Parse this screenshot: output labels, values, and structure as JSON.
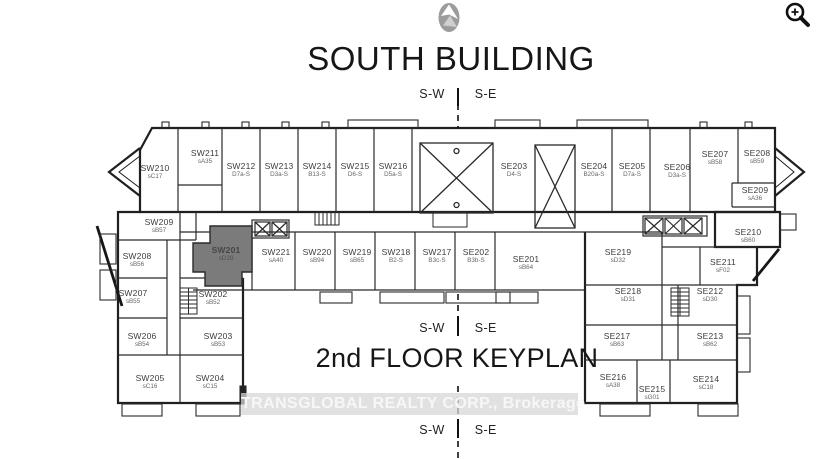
{
  "page": {
    "title": "SOUTH BUILDING",
    "keyplan_caption": "2nd FLOOR KEYPLAN",
    "direction_left": "S-W",
    "direction_right": "S-E",
    "watermark": "TRANSGLOBAL REALTY CORP., Brokerage",
    "highlight_color": "#7b7b7b",
    "wall_color": "#1f1f1f"
  },
  "icons": {
    "logo": "brand-logo",
    "zoom": "zoom-in-icon"
  },
  "units": [
    {
      "id": "SW210",
      "code": "sC17",
      "x": 155,
      "y": 172
    },
    {
      "id": "SW211",
      "code": "sA35",
      "x": 205,
      "y": 157
    },
    {
      "id": "SW212",
      "code": "D7a-S",
      "x": 241,
      "y": 170
    },
    {
      "id": "SW213",
      "code": "D3a-S",
      "x": 279,
      "y": 170
    },
    {
      "id": "SW214",
      "code": "B13-S",
      "x": 317,
      "y": 170
    },
    {
      "id": "SW215",
      "code": "D6-S",
      "x": 355,
      "y": 170
    },
    {
      "id": "SW216",
      "code": "D5a-S",
      "x": 393,
      "y": 170
    },
    {
      "id": "SE203",
      "code": "D4-S",
      "x": 514,
      "y": 170
    },
    {
      "id": "SE204",
      "code": "B20a-S",
      "x": 594,
      "y": 170
    },
    {
      "id": "SE205",
      "code": "D7a-S",
      "x": 632,
      "y": 170
    },
    {
      "id": "SE206",
      "code": "D3a-S",
      "x": 677,
      "y": 171
    },
    {
      "id": "SE207",
      "code": "sB58",
      "x": 715,
      "y": 158
    },
    {
      "id": "SE208",
      "code": "sB59",
      "x": 757,
      "y": 157
    },
    {
      "id": "SE209",
      "code": "sA36",
      "x": 755,
      "y": 194
    },
    {
      "id": "SW209",
      "code": "sB57",
      "x": 159,
      "y": 226
    },
    {
      "id": "SW208",
      "code": "sB56",
      "x": 137,
      "y": 260
    },
    {
      "id": "SW207",
      "code": "sB55",
      "x": 133,
      "y": 297
    },
    {
      "id": "SW206",
      "code": "sB54",
      "x": 142,
      "y": 340
    },
    {
      "id": "SW205",
      "code": "sC16",
      "x": 150,
      "y": 382
    },
    {
      "id": "SW204",
      "code": "sC15",
      "x": 210,
      "y": 382
    },
    {
      "id": "SW203",
      "code": "sB53",
      "x": 218,
      "y": 340
    },
    {
      "id": "SW202",
      "code": "sB52",
      "x": 213,
      "y": 298
    },
    {
      "id": "SW201",
      "code": "sD39",
      "x": 226,
      "y": 254,
      "highlighted": true
    },
    {
      "id": "SW221",
      "code": "sA40",
      "x": 276,
      "y": 256
    },
    {
      "id": "SW220",
      "code": "sB94",
      "x": 317,
      "y": 256
    },
    {
      "id": "SW219",
      "code": "sB65",
      "x": 357,
      "y": 256
    },
    {
      "id": "SW218",
      "code": "B2-S",
      "x": 396,
      "y": 256
    },
    {
      "id": "SW217",
      "code": "B3c-S",
      "x": 437,
      "y": 256
    },
    {
      "id": "SE202",
      "code": "B3b-S",
      "x": 476,
      "y": 256
    },
    {
      "id": "SE201",
      "code": "sB64",
      "x": 526,
      "y": 263
    },
    {
      "id": "SE219",
      "code": "sD32",
      "x": 618,
      "y": 256
    },
    {
      "id": "SE218",
      "code": "sD31",
      "x": 628,
      "y": 295
    },
    {
      "id": "SE217",
      "code": "sB63",
      "x": 617,
      "y": 340
    },
    {
      "id": "SE216",
      "code": "sA38",
      "x": 613,
      "y": 381
    },
    {
      "id": "SE215",
      "code": "sG01",
      "x": 652,
      "y": 393
    },
    {
      "id": "SE214",
      "code": "sC18",
      "x": 706,
      "y": 383
    },
    {
      "id": "SE213",
      "code": "sB62",
      "x": 710,
      "y": 340
    },
    {
      "id": "SE212",
      "code": "sD30",
      "x": 710,
      "y": 295
    },
    {
      "id": "SE211",
      "code": "sF02",
      "x": 723,
      "y": 266
    },
    {
      "id": "SE210",
      "code": "sB60",
      "x": 748,
      "y": 236
    }
  ]
}
